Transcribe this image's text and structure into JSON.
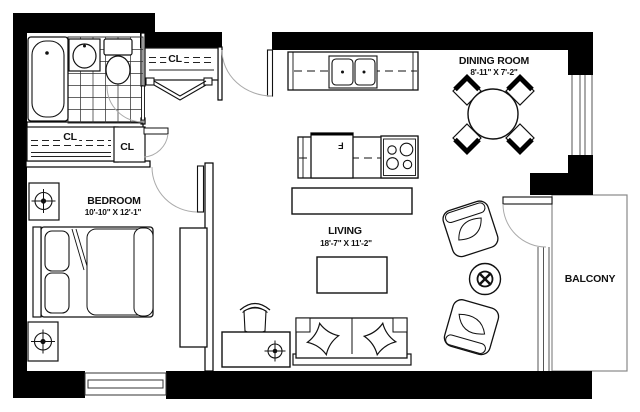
{
  "plan": {
    "rooms": {
      "dining": {
        "name": "DINING ROOM",
        "dimensions": "8'-11\" X 7'-2\""
      },
      "bedroom": {
        "name": "BEDROOM",
        "dimensions": "10'-10\" X 12'-1\""
      },
      "living": {
        "name": "LIVING",
        "dimensions": "18'-7\" X 11'-2\""
      },
      "balcony": {
        "name": "BALCONY"
      }
    },
    "closets": {
      "hall_closet_label": "CL",
      "bedroom_wide_closet_label": "CL",
      "bedroom_small_closet_label": "CL"
    },
    "appliances": {
      "fridge_label": "F"
    },
    "colors": {
      "walls": "#000000",
      "background": "#ffffff",
      "furniture_line": "#1a1a1a",
      "swing_line": "#aaaaaa",
      "window_line": "#555555"
    }
  }
}
